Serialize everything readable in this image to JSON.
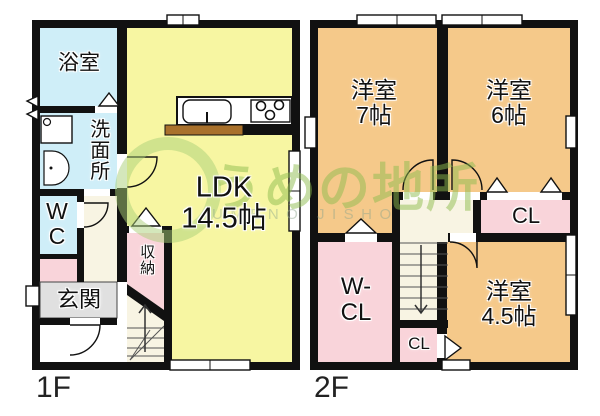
{
  "watermark": {
    "brand": "うめの地所",
    "brand_roman": "UMENO JISHO"
  },
  "floor1": {
    "label": "1F",
    "rooms": {
      "bath": "浴室",
      "washroom": "洗面所",
      "wc": "W\nC",
      "entrance": "玄関",
      "storage": "収納",
      "ldk": "LDK\n14.5帖"
    }
  },
  "floor2": {
    "label": "2F",
    "rooms": {
      "west7": "洋室\n7帖",
      "west6": "洋室\n6帖",
      "west45": "洋室\n4.5帖",
      "walkin_closet": "W-\nCL",
      "closet_right": "CL",
      "closet_small": "CL"
    }
  },
  "colors": {
    "ldk_yellow": "#f7f6a2",
    "wet_area_blue": "#cfeef8",
    "closet_pink": "#f9d4da",
    "bedroom_orange": "#f5c98a",
    "entrance_gray": "#e0e0e0",
    "hall_cream": "#f8f4e3",
    "wall_black": "#111111",
    "counter_brown": "#a9712c",
    "watermark_green": "#8bba4a"
  }
}
